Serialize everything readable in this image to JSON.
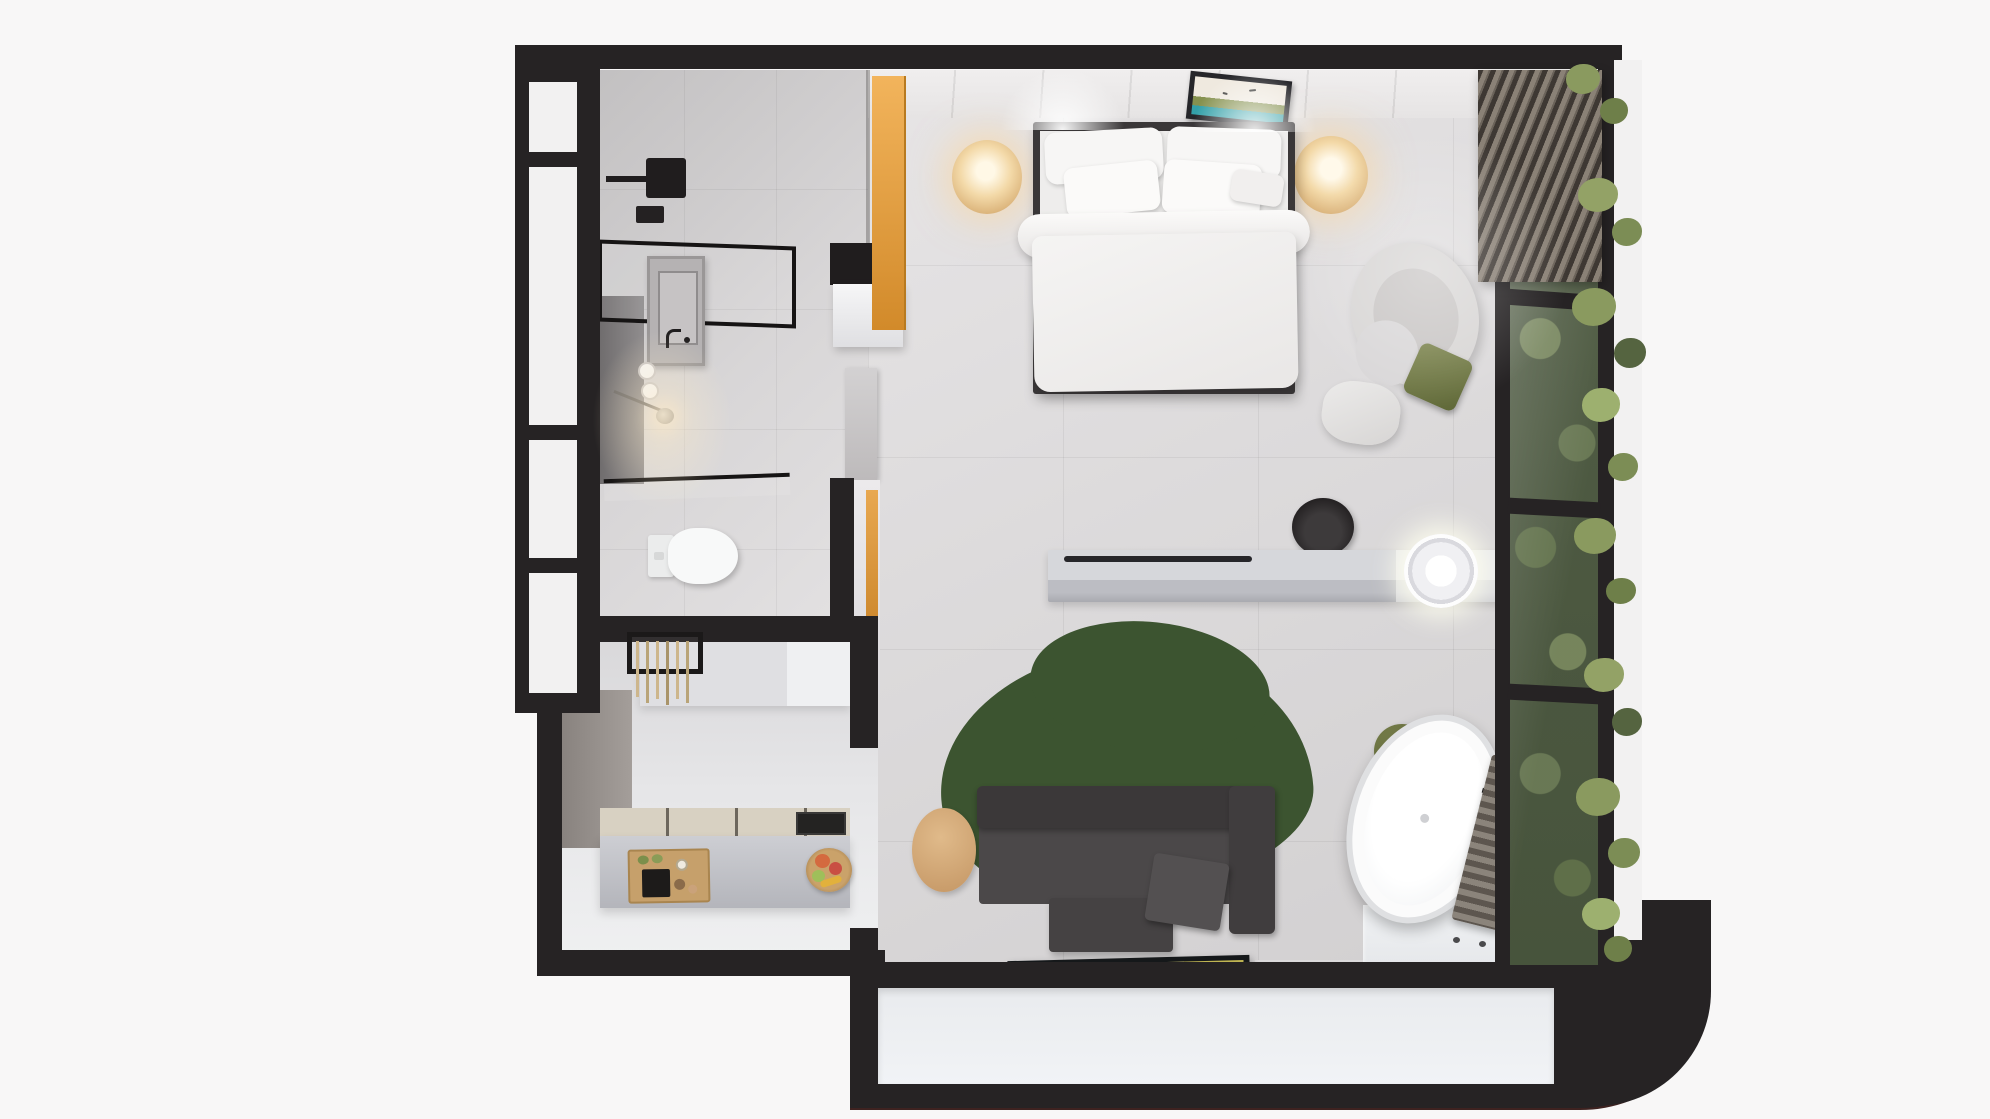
{
  "scene": {
    "title": "Top-down 3D render of a studio apartment floor plan",
    "view": "bird's-eye interior render, no visible text"
  },
  "palette": {
    "background": "#f8f7f7",
    "wall_black": "#262324",
    "floor_gray": "#d8d6d7",
    "accent_orange": "#e8a34c",
    "rug_green": "#3d5531",
    "plant_green": "#7c8d55",
    "sofa_charcoal": "#4a4748",
    "wood_tan": "#cfa878",
    "lamp_warm": "#ecc995",
    "art_teal": "#33a0a8",
    "linen_white": "#f3f2f1"
  },
  "rooms": {
    "bedroom": {
      "label": "Bedroom",
      "bed": "Double bed with white duvet and five pillows on dark frame",
      "art": "Framed landscape artwork with birds above headboard",
      "lamp_left": "Round warm bedside lamp (left)",
      "lamp_right": "Round warm bedside lamp (right)",
      "wardrobe": "Wardrobe with orange side panel",
      "lounge_chair": "Curved light-gray lounge chair",
      "cushion": "Olive green cushion",
      "pouf": "Small white pouf",
      "desk": "Floating console desk",
      "desk_chair": "Black round desk chair",
      "basin": "Illuminated round countertop basin"
    },
    "bathroom": {
      "label": "Bathroom",
      "shower": "Walk-in shower with black fixtures",
      "glass_top": "Black framed glass shower screen",
      "glass_low": "Black framed glass partition",
      "vanity": "Vanity unit with basin and faucet",
      "pendant": "Small pendant light",
      "rolls": "Toilet paper rolls",
      "toilet": "Wall-hung toilet",
      "towel_rail": "Towel rail with hanging towels"
    },
    "kitchen": {
      "label": "Kitchenette",
      "counter": "Counter with beige worktop and sink",
      "board": "Wooden cutting board with snacks",
      "fruit": "Fruit bowl",
      "cabinets": "Upper cabinets"
    },
    "living": {
      "label": "Living area",
      "sofa": "Charcoal sofa with chaise and cushion",
      "rug": "Organic-shaped dark green rug",
      "side_table": "Round wooden side table",
      "tv": "Flat TV with beach artwork lying on floor",
      "speaker": "Round black speaker"
    },
    "spa": {
      "label": "Bath corner",
      "tub": "Freestanding oval bathtub",
      "stool": "Olive round stool",
      "faucet": "Black floor-mounted faucet",
      "radiator": "Slatted bench radiator",
      "platform": "White wet-room platform with drain holes"
    },
    "balcony": {
      "label": "Balcony",
      "deck": "White deck wrapped by black parapet with rounded corner"
    },
    "facade": {
      "label": "Facade",
      "left_window": "Black framed frosted window wall",
      "right_glass": "Black framed glass wall",
      "green_wall": "Vertical garden behind glass",
      "louvers": "Louvered screen at top right",
      "plants": "Greenery overflowing the right facade"
    }
  }
}
